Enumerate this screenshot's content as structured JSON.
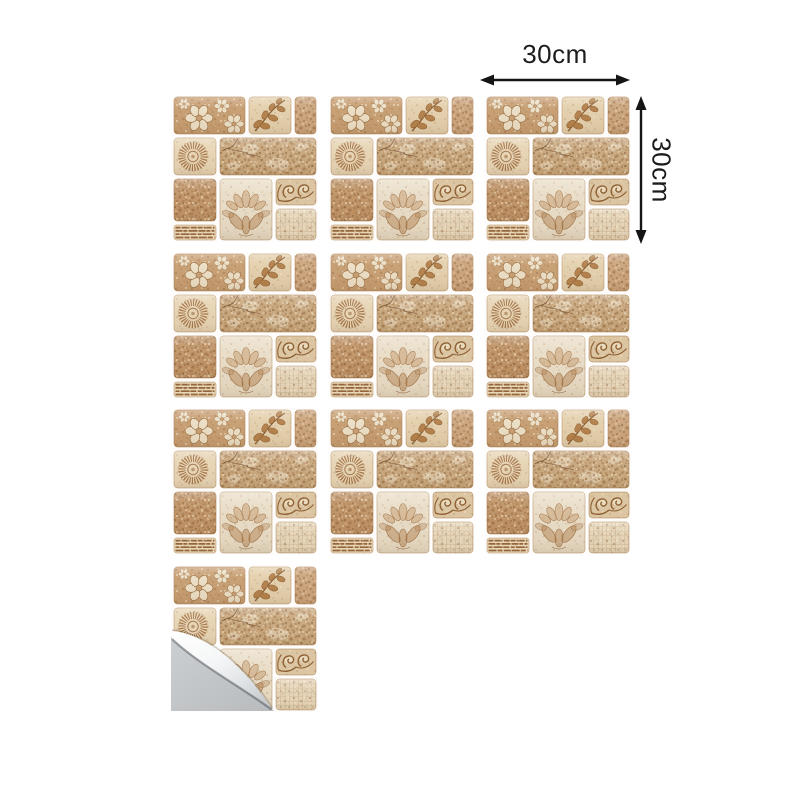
{
  "page": {
    "type": "e-commerce product image",
    "subject": "Self-adhesive beige stone mosaic wall tile stickers",
    "background_color": "#ffffff"
  },
  "dimension_annotation": {
    "width_label": "30cm",
    "height_label": "30cm",
    "arrow_color": "#151515",
    "text_color": "#1c1c1c"
  },
  "tile_grid": {
    "tile_count": 10,
    "columns": 3,
    "rows": 4,
    "tiles_in_last_row": 1,
    "peeled_tile": 10
  },
  "tile_pattern": {
    "style": "beige stone mosaic with floral motifs",
    "blocks": [
      "flower-cluster",
      "leaf-branch",
      "speckled-square",
      "sunburst-medallion",
      "rough-stone-slab",
      "dark-speckled-square",
      "striped-bar",
      "lotus-flower-panel",
      "scroll-ornament",
      "mesh-grid"
    ],
    "palette": {
      "tan": "#c79e72",
      "cream": "#ecdfc6",
      "light_beige": "#e7d5b5",
      "stone": "#c9a87e",
      "brown_accent": "#8a5c30"
    }
  },
  "peel_corner": {
    "backing_color": "#c2c5c8",
    "curl_highlight": "#ffffff",
    "curl_shade": "#c7cbce"
  }
}
